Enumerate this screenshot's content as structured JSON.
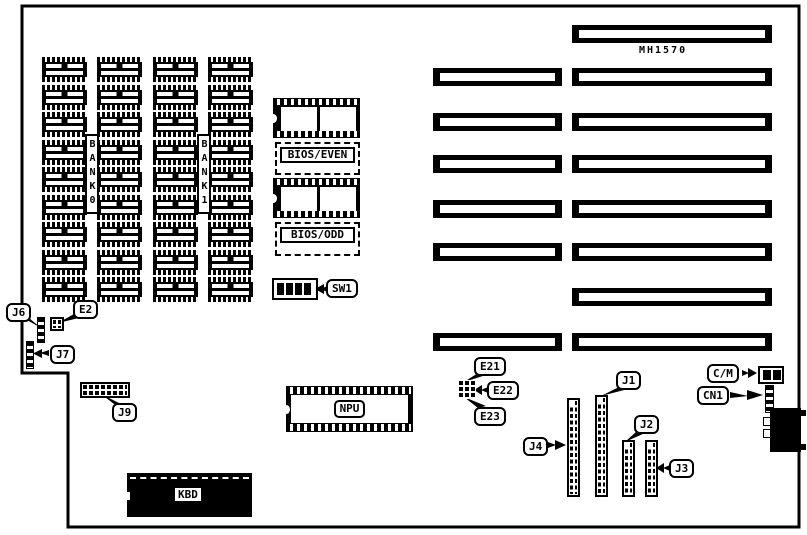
{
  "board": {
    "part_number": "MH1570",
    "background": "#ffffff",
    "ink": "#000000"
  },
  "memory": {
    "rows": 9,
    "columns": 4,
    "bank_labels": [
      "BANK0",
      "BANK1"
    ]
  },
  "chips": {
    "bios_even": "BIOS/EVEN",
    "bios_odd": "BIOS/ODD",
    "npu": "NPU",
    "kbd": "KBD"
  },
  "sw1": {
    "label": "SW1",
    "positions": 4
  },
  "slots": {
    "count": 8,
    "rows_y": [
      25,
      68,
      113,
      155,
      200,
      243,
      288,
      333
    ],
    "left_present": [
      false,
      true,
      true,
      true,
      true,
      true,
      false,
      true
    ]
  },
  "callouts": {
    "j6": "J6",
    "e2": "E2",
    "j7": "J7",
    "j9": "J9",
    "e21": "E21",
    "e22": "E22",
    "e23": "E23",
    "j4": "J4",
    "j1": "J1",
    "j2": "J2",
    "j3": "J3",
    "cm": "C/M",
    "cn1": "CN1",
    "sw1": "SW1"
  }
}
